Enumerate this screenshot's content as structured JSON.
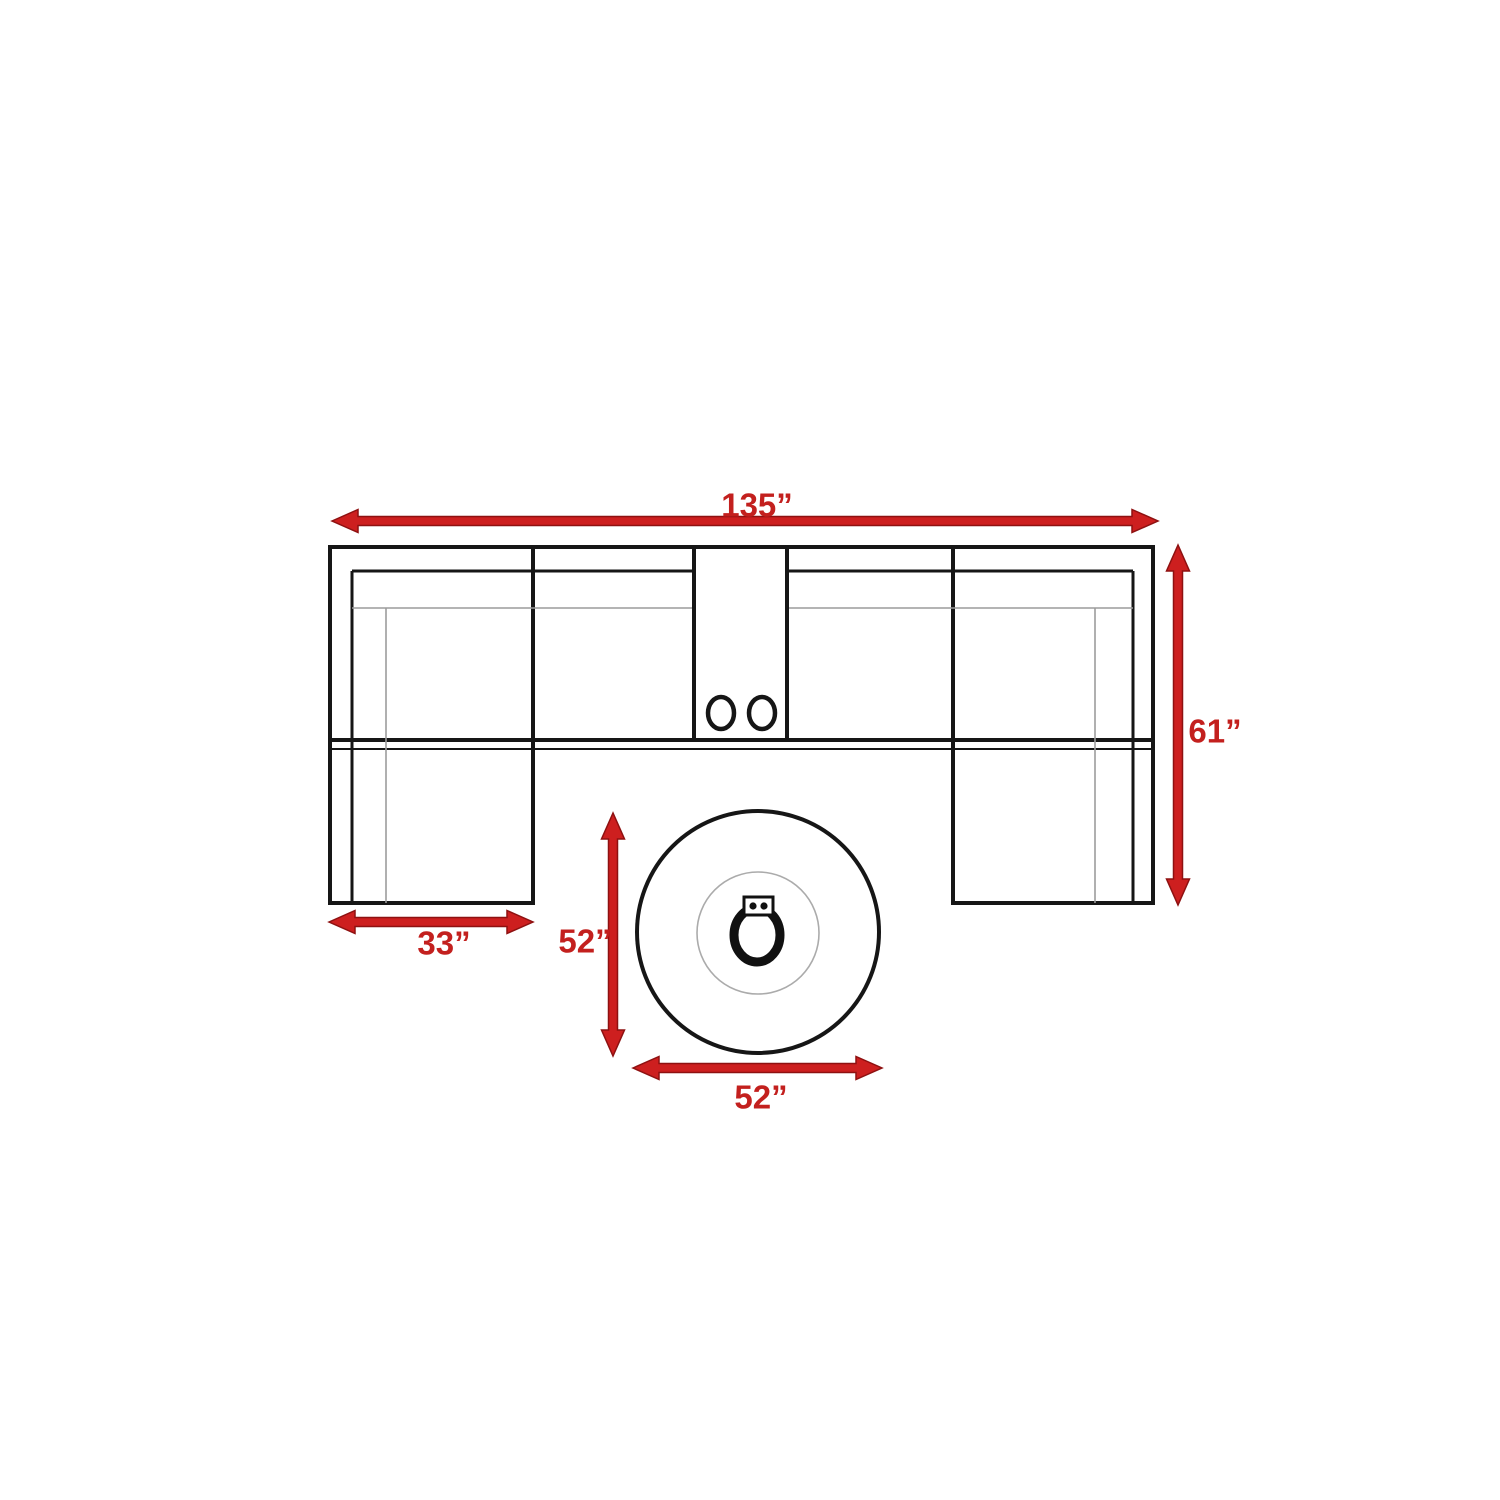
{
  "diagram": {
    "title": "Sectional sofa with round fire pit table — top-view dimension plan",
    "dimensions": {
      "sofa_width": {
        "label": "135”",
        "value": 135,
        "unit": "inches"
      },
      "sofa_depth": {
        "label": "61”",
        "value": 61,
        "unit": "inches"
      },
      "chaise_width": {
        "label": "33”",
        "value": 33,
        "unit": "inches"
      },
      "table_depth": {
        "label": "52”",
        "value": 52,
        "unit": "inches"
      },
      "table_width": {
        "label": "52”",
        "value": 52,
        "unit": "inches"
      }
    },
    "icons": [
      "cup-holder-icon",
      "fire-pit-burner-icon",
      "fire-pit-control-panel-icon",
      "dimension-arrow-icon"
    ],
    "colors": {
      "arrow_red": "#cd1f1f",
      "arrow_edge_red": "#8e1111",
      "label_red": "#c3201e",
      "line_black": "#161616",
      "line_gray": "#9c9c9c",
      "background": "#ffffff"
    }
  }
}
